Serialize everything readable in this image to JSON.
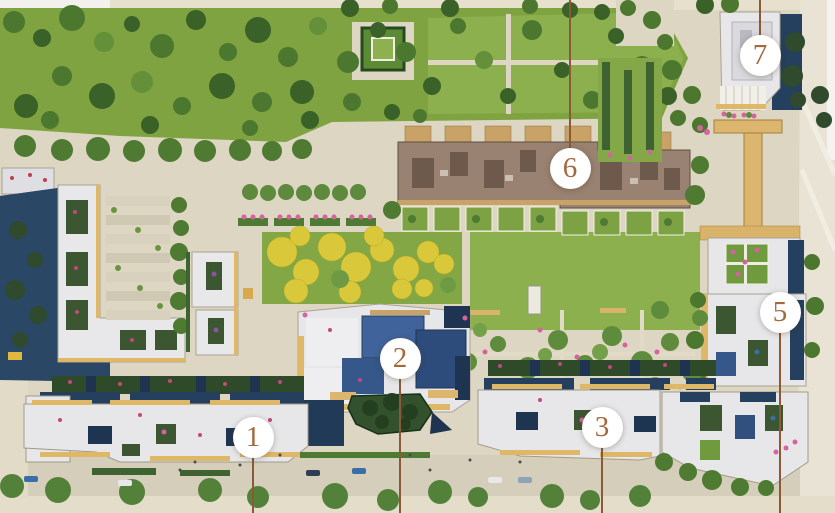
{
  "map": {
    "markers": [
      {
        "number": "1",
        "x": 253,
        "y": 437,
        "leader": "down"
      },
      {
        "number": "2",
        "x": 400,
        "y": 358,
        "leader": "down"
      },
      {
        "number": "3",
        "x": 602,
        "y": 427,
        "leader": "down"
      },
      {
        "number": "5",
        "x": 780,
        "y": 312,
        "leader": "down"
      },
      {
        "number": "6",
        "x": 570,
        "y": 168,
        "leader": "up"
      },
      {
        "number": "7",
        "x": 760,
        "y": 55,
        "leader": "up"
      }
    ],
    "colors": {
      "marker_background": "#ffffff",
      "marker_number": "#a4683a",
      "leader_line": "#8a5a38",
      "park_grass": "#7fa341",
      "lawn": "#8cb04d",
      "pavement": "#ddd6c2",
      "roof_white": "#e7e7ea",
      "roof_trim_tan": "#dfb867",
      "building_shadow_navy": "#24405e",
      "townhouse_roof_brown": "#9a8272",
      "autumn_trees_yellow": "#d9c93a",
      "flower_pink": "#d4639e"
    }
  }
}
